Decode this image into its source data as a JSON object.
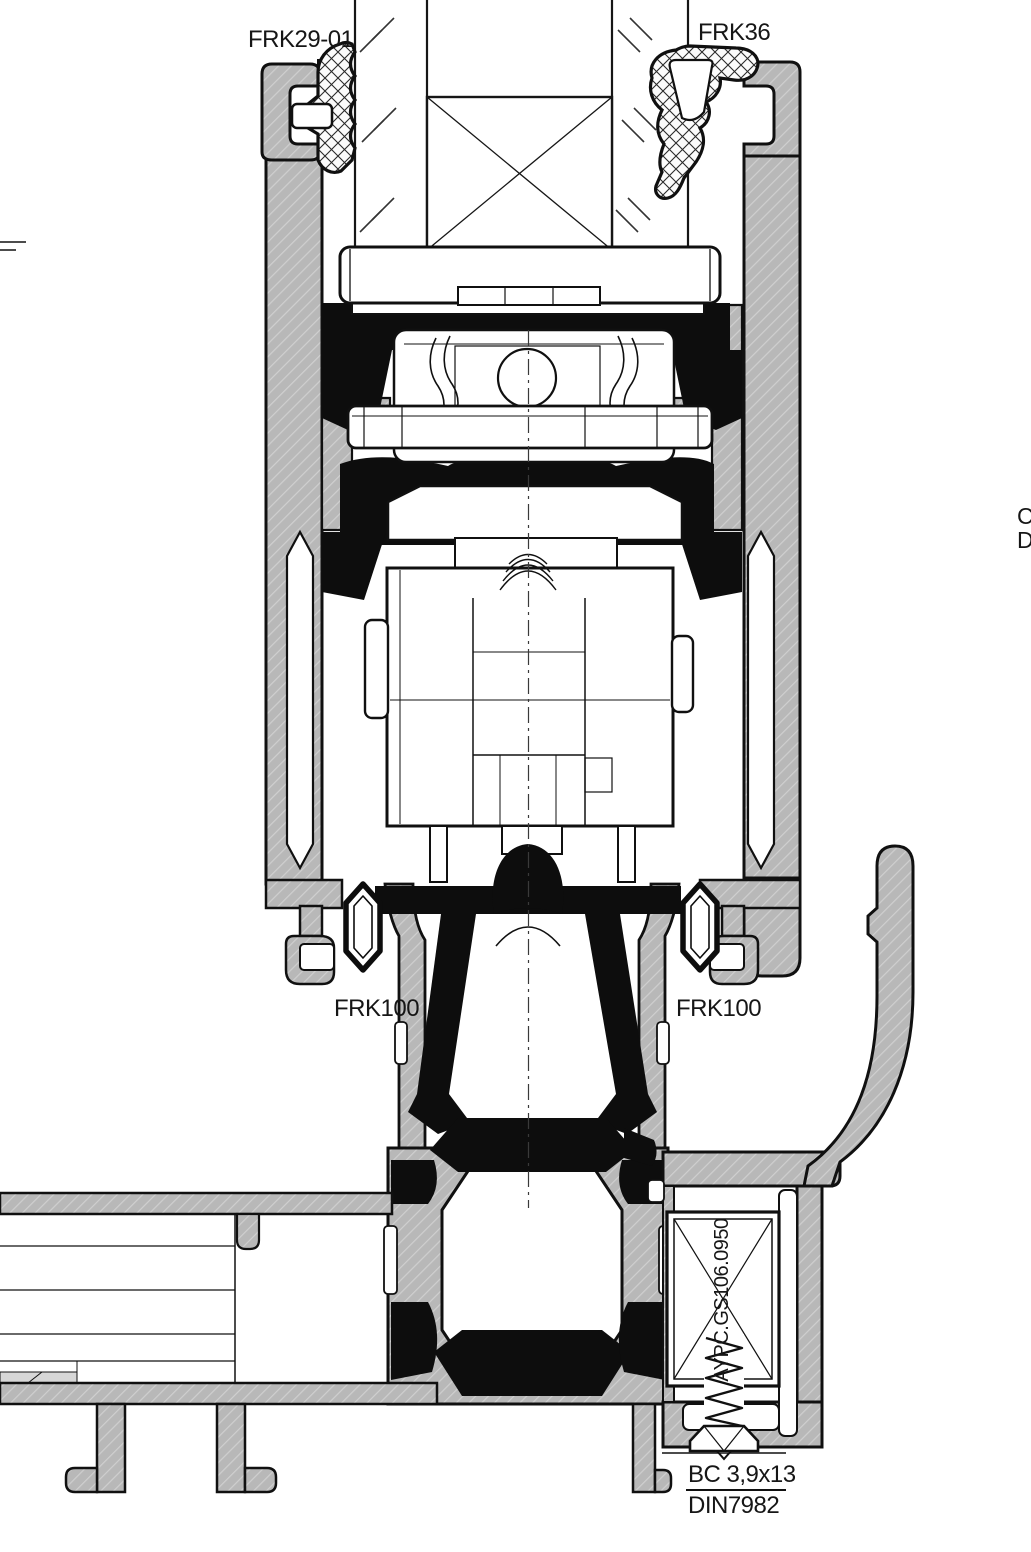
{
  "drawing": {
    "background": "#ffffff",
    "colors": {
      "aluminum_fill": "#b8b8b8",
      "aluminum_hatch_line": "#cfcfcf",
      "outline_black": "#101010",
      "rubber_black": "#0d0d0d",
      "gasket_crosshatch": "#2a2a2a",
      "white": "#ffffff",
      "centerline": "#3a3a3a"
    },
    "labels": {
      "top_left_gasket": "FRK29-01",
      "top_right_gasket": "FRK36",
      "mid_left_gasket": "FRK100",
      "mid_right_gasket": "FRK100",
      "insulator_code": "AYPC.GS106.0950",
      "screw_size": "BC 3,9x13",
      "screw_standard": "DIN7982",
      "edge_letter_top": "C",
      "edge_letter_bottom": "D"
    }
  }
}
